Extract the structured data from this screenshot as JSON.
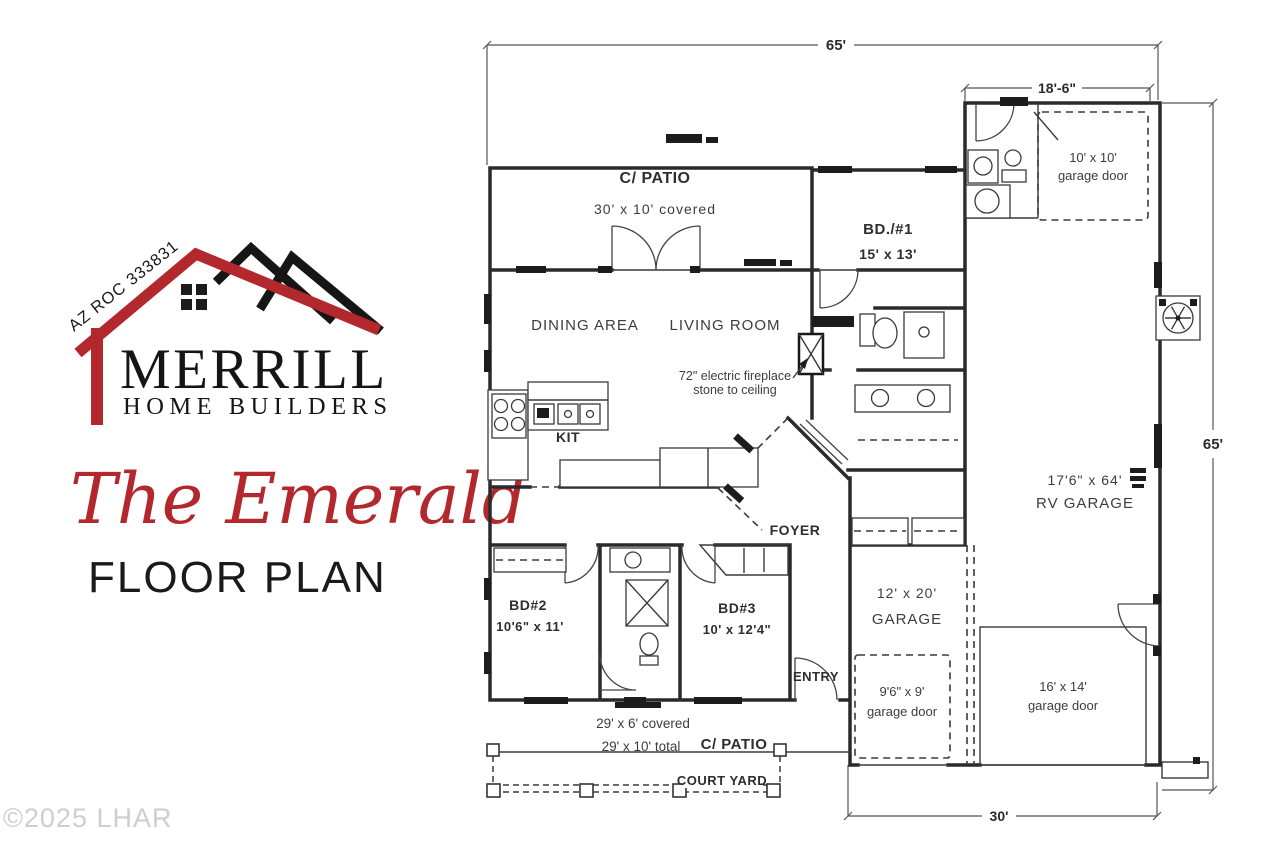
{
  "branding": {
    "license": "AZ ROC 333831",
    "company": "MERRILL",
    "tagline": "HOME BUILDERS",
    "plan_name": "The Emerald",
    "plan_type": "FLOOR PLAN",
    "brand_red": "#b3282d",
    "brand_black": "#161616"
  },
  "watermark": "©2025 LHAR",
  "floor_plan": {
    "dimensions": {
      "overall_width": "65'",
      "overall_height": "65'",
      "garage_block_width": "18'-6\"",
      "garage_block_bottom": "30'"
    },
    "rooms": {
      "patio_top": {
        "name": "C/ PATIO",
        "size": "30' x 10' covered"
      },
      "dining": {
        "name": "DINING AREA"
      },
      "living": {
        "name": "LIVING ROOM"
      },
      "kitchen": {
        "name": "KIT"
      },
      "bd1": {
        "name": "BD./#1",
        "size": "15' x 13'"
      },
      "bd2": {
        "name": "BD#2",
        "size": "10'6\" x 11'"
      },
      "bd3": {
        "name": "BD#3",
        "size": "10' x 12'4\""
      },
      "foyer": {
        "name": "FOYER"
      },
      "entry": {
        "name": "ENTRY"
      },
      "garage": {
        "name": "GARAGE",
        "size": "12' x 20'"
      },
      "rv_garage": {
        "name": "RV GARAGE",
        "size": "17'6\" x 64'"
      },
      "patio_bottom": {
        "name": "C/ PATIO",
        "size_line1": "29' x 6' covered",
        "size_line2": "29' x 10' total"
      },
      "court_yard": {
        "name": "COURT YARD"
      }
    },
    "notes": {
      "fireplace_line1": "72\" electric fireplace",
      "fireplace_line2": "stone to ceiling"
    },
    "garage_doors": {
      "door_10x10": {
        "line1": "10' x 10'",
        "line2": "garage door"
      },
      "door_9x9": {
        "line1": "9'6\" x 9'",
        "line2": "garage door"
      },
      "door_16x14": {
        "line1": "16' x 14'",
        "line2": "garage door"
      }
    }
  }
}
